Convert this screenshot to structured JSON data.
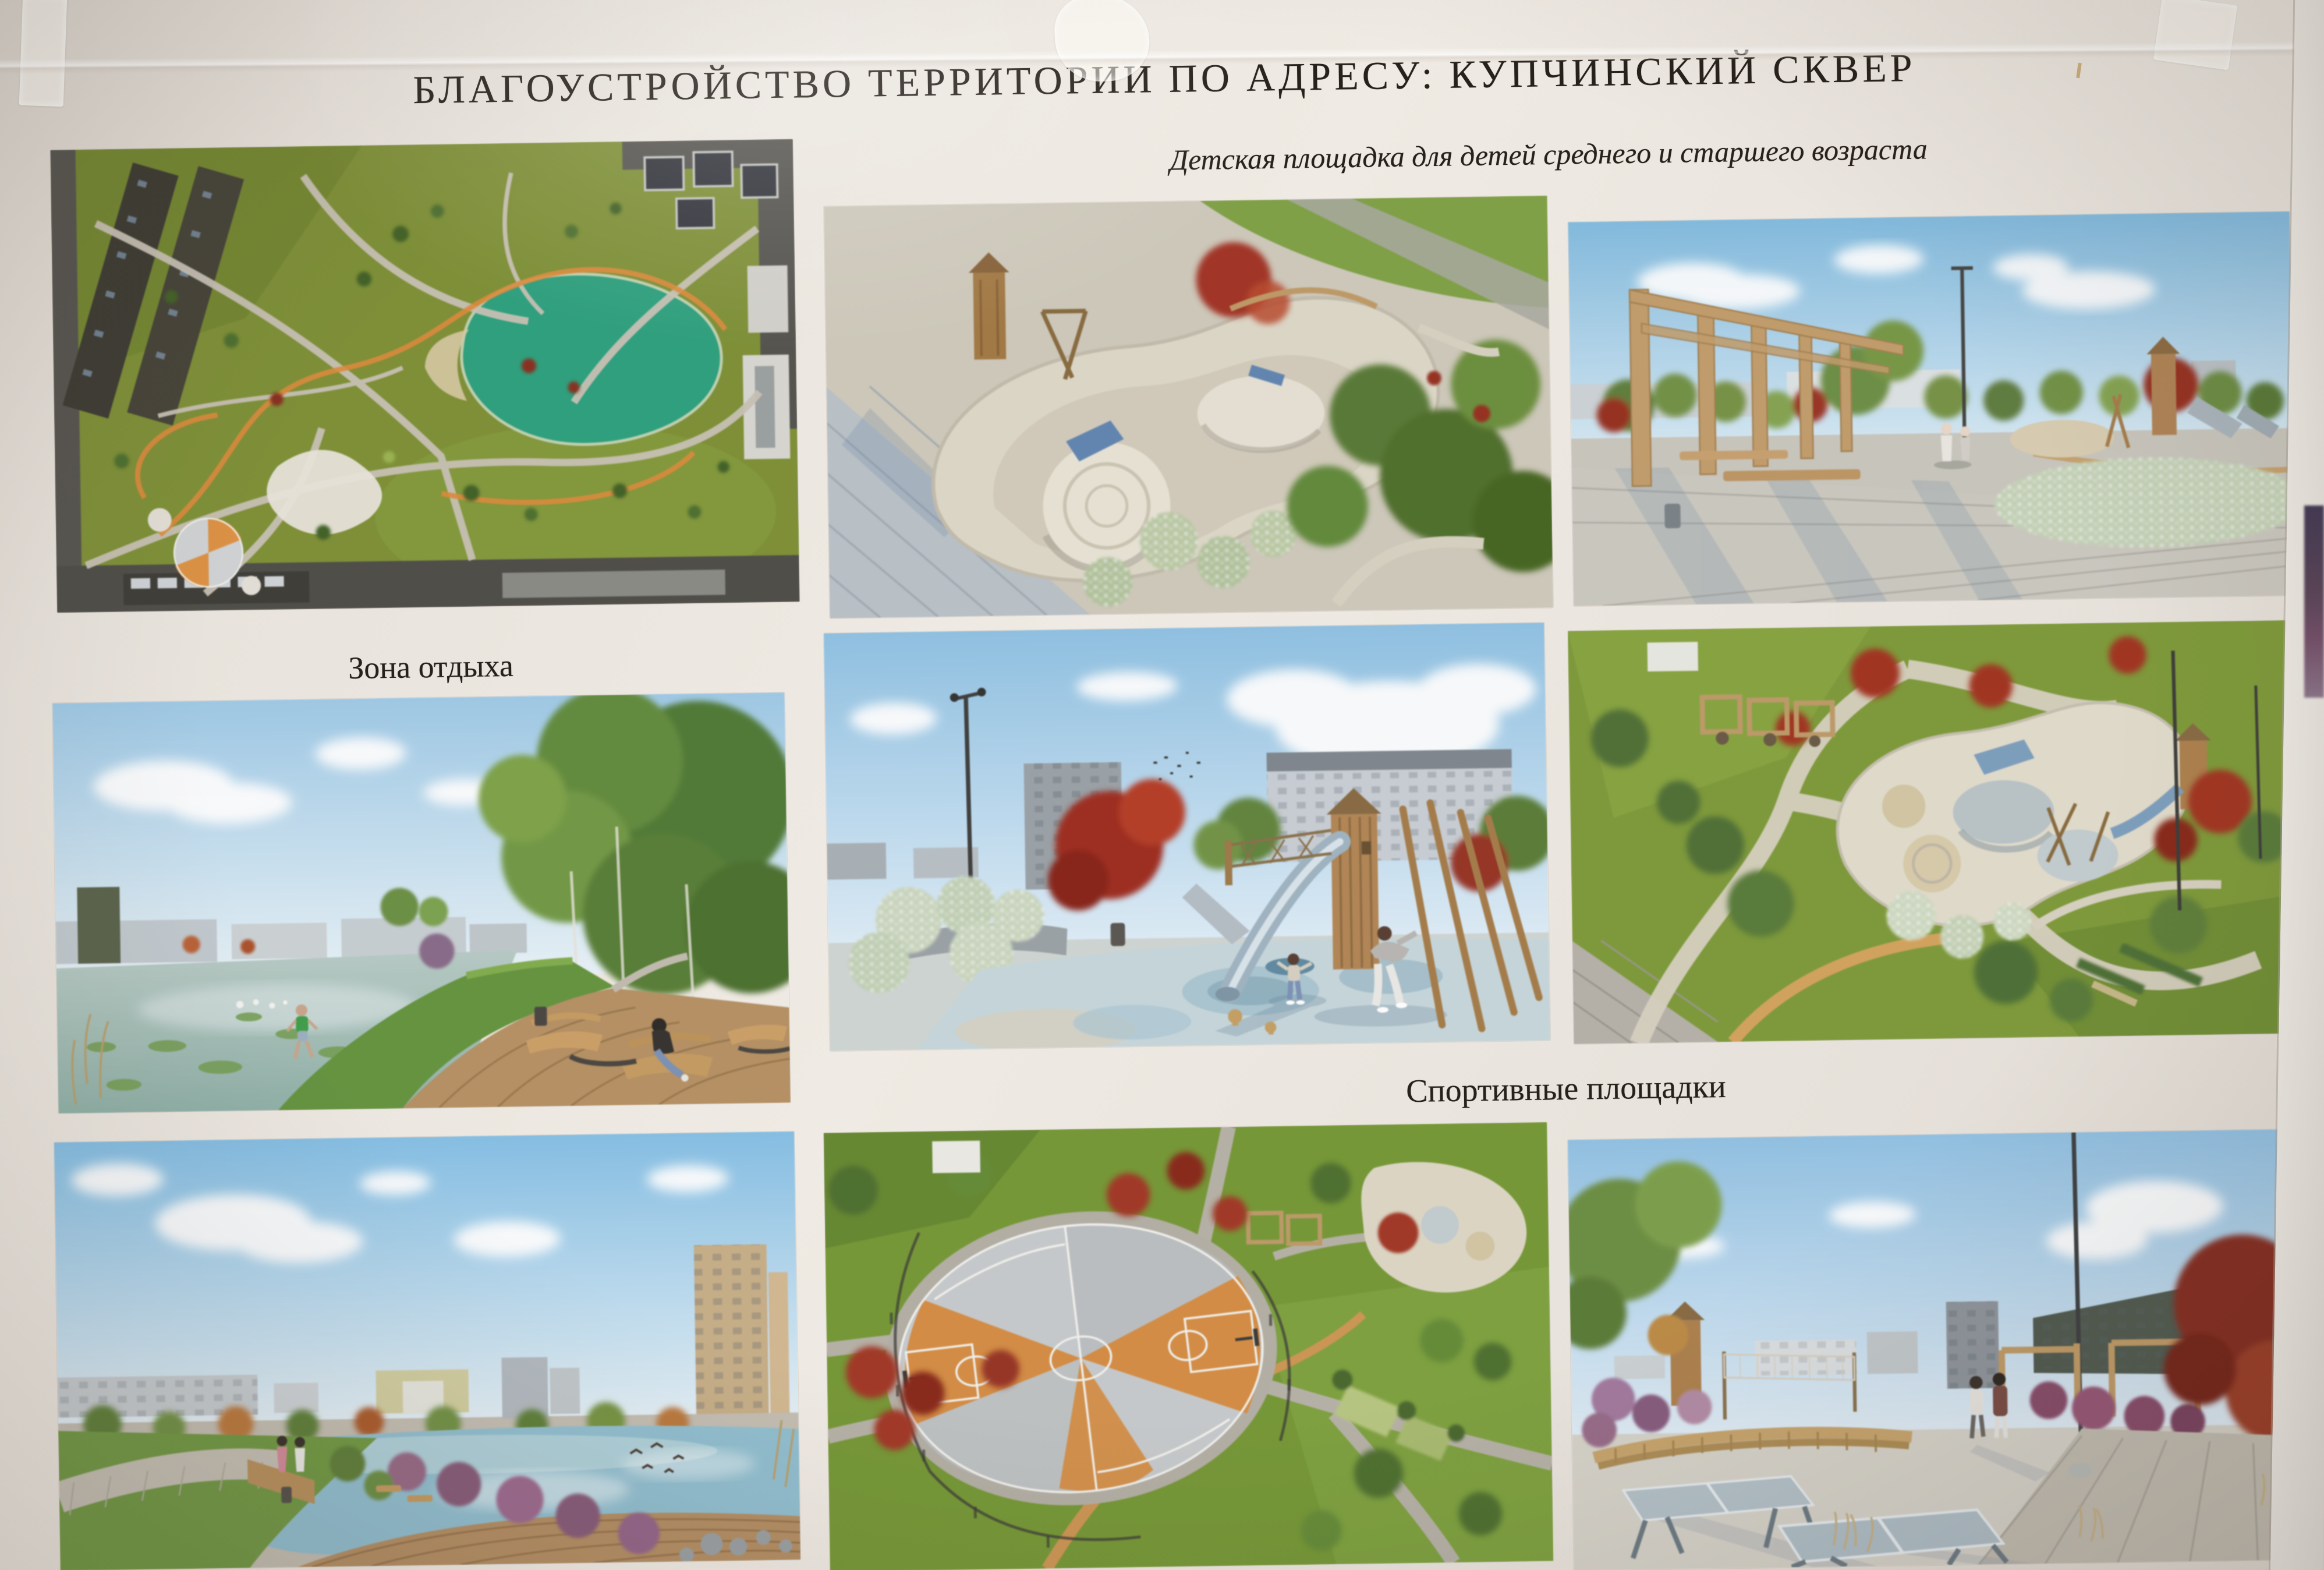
{
  "poster": {
    "title": "БЛАГОУСТРОЙСТВО ТЕРРИТОРИИ ПО АДРЕСУ: КУПЧИНСКИЙ СКВЕР",
    "captions": {
      "playground": "Детская площадка для детей среднего и старшего возраста",
      "rest_zone": "Зона отдыха",
      "sports": "Спортивные площадки"
    },
    "renderings": [
      {
        "name": "site-masterplan-aerial"
      },
      {
        "name": "playground-mounds-aerial"
      },
      {
        "name": "pergola-walkway-view"
      },
      {
        "name": "lake-boardwalk-benches"
      },
      {
        "name": "tube-slide-tower-playground"
      },
      {
        "name": "playground-loops-aerial"
      },
      {
        "name": "pond-promenade-view"
      },
      {
        "name": "round-basketball-court-aerial"
      },
      {
        "name": "table-tennis-plaza-view"
      }
    ],
    "colors": {
      "paper": "#e5e0d9",
      "ink": "#27211b",
      "sky": "#9cc8e8",
      "grass": "#7d9b33",
      "pond_teal": "#2aa27c",
      "water": "#8fc0d2",
      "wood": "#b5854f",
      "maple_red": "#a83420",
      "path_orange": "#d1954e",
      "court_orange": "#d98c3e"
    }
  }
}
